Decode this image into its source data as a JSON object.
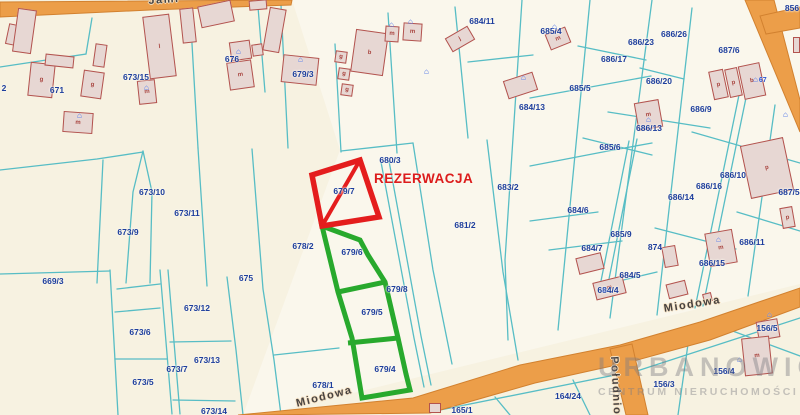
{
  "map": {
    "title": "cadastral parcel map",
    "colors": {
      "background": "#f7f2e1",
      "parcel_line": "#57bdc5",
      "road_fill": "#ec9e49",
      "road_edge": "#d2812f",
      "building_fill": "#e7d7d3",
      "building_edge": "#b3534e",
      "label_blue": "#1d3e9d",
      "reservation_red": "#dc1c1c",
      "highlight_green": "#28a92d"
    },
    "reservation": {
      "label": "REZERWACJA"
    },
    "watermark": {
      "line1": "URBANOWICZ",
      "line2": "CENTRUM NIERUCHOMOŚCI"
    },
    "streets": [
      {
        "name": "Jami",
        "x": 148,
        "y": -5,
        "rot": -4
      },
      {
        "name": "Miodowa",
        "x": 663,
        "y": 303,
        "rot": -9
      },
      {
        "name": "Miodowa",
        "x": 295,
        "y": 398,
        "rot": -14
      },
      {
        "name": "Południowa",
        "x": 620,
        "y": 356,
        "rot": 87
      }
    ],
    "parcel_labels": [
      {
        "t": "2",
        "x": 4,
        "y": 88
      },
      {
        "t": "671",
        "x": 57,
        "y": 90
      },
      {
        "t": "673/15",
        "x": 136,
        "y": 77
      },
      {
        "t": "676",
        "x": 232,
        "y": 59
      },
      {
        "t": "679/3",
        "x": 303,
        "y": 74
      },
      {
        "t": "684/11",
        "x": 482,
        "y": 21
      },
      {
        "t": "685/4",
        "x": 551,
        "y": 31
      },
      {
        "t": "686/23",
        "x": 641,
        "y": 42
      },
      {
        "t": "686/26",
        "x": 674,
        "y": 34
      },
      {
        "t": "687/6",
        "x": 729,
        "y": 50
      },
      {
        "t": "856",
        "x": 792,
        "y": 8
      },
      {
        "t": "686/17",
        "x": 614,
        "y": 59
      },
      {
        "t": "686/20",
        "x": 659,
        "y": 81
      },
      {
        "t": "685/5",
        "x": 580,
        "y": 88
      },
      {
        "t": "684/13",
        "x": 532,
        "y": 107
      },
      {
        "t": "686/9",
        "x": 701,
        "y": 109
      },
      {
        "t": "686/13",
        "x": 649,
        "y": 128
      },
      {
        "t": "685/6",
        "x": 610,
        "y": 147
      },
      {
        "t": "686/10",
        "x": 733,
        "y": 175
      },
      {
        "t": "686/16",
        "x": 709,
        "y": 186
      },
      {
        "t": "686/14",
        "x": 681,
        "y": 197
      },
      {
        "t": "687/5",
        "x": 789,
        "y": 192
      },
      {
        "t": "684/6",
        "x": 578,
        "y": 210
      },
      {
        "t": "685/9",
        "x": 621,
        "y": 234
      },
      {
        "t": "686/11",
        "x": 752,
        "y": 242
      },
      {
        "t": "684/7",
        "x": 592,
        "y": 248
      },
      {
        "t": "874",
        "x": 655,
        "y": 247
      },
      {
        "t": "686/15",
        "x": 712,
        "y": 263
      },
      {
        "t": "684/5",
        "x": 630,
        "y": 275
      },
      {
        "t": "684/4",
        "x": 608,
        "y": 290
      },
      {
        "t": "673/10",
        "x": 152,
        "y": 192
      },
      {
        "t": "673/11",
        "x": 187,
        "y": 213
      },
      {
        "t": "673/9",
        "x": 128,
        "y": 232
      },
      {
        "t": "680/3",
        "x": 390,
        "y": 160
      },
      {
        "t": "679/7",
        "x": 344,
        "y": 191
      },
      {
        "t": "683/2",
        "x": 508,
        "y": 187
      },
      {
        "t": "681/2",
        "x": 465,
        "y": 225
      },
      {
        "t": "678/2",
        "x": 303,
        "y": 246
      },
      {
        "t": "679/6",
        "x": 352,
        "y": 252
      },
      {
        "t": "675",
        "x": 246,
        "y": 278
      },
      {
        "t": "679/8",
        "x": 397,
        "y": 289
      },
      {
        "t": "679/5",
        "x": 372,
        "y": 312
      },
      {
        "t": "669/3",
        "x": 53,
        "y": 281
      },
      {
        "t": "673/12",
        "x": 197,
        "y": 308
      },
      {
        "t": "673/6",
        "x": 140,
        "y": 332
      },
      {
        "t": "673/13",
        "x": 207,
        "y": 360
      },
      {
        "t": "673/7",
        "x": 177,
        "y": 369
      },
      {
        "t": "679/4",
        "x": 385,
        "y": 369
      },
      {
        "t": "673/5",
        "x": 143,
        "y": 382
      },
      {
        "t": "678/1",
        "x": 323,
        "y": 385
      },
      {
        "t": "673/14",
        "x": 214,
        "y": 411
      },
      {
        "t": "156/5",
        "x": 767,
        "y": 328
      },
      {
        "t": "156/4",
        "x": 724,
        "y": 371
      },
      {
        "t": "156/3",
        "x": 664,
        "y": 384
      },
      {
        "t": "164/24",
        "x": 568,
        "y": 396
      },
      {
        "t": "165/1",
        "x": 462,
        "y": 410
      }
    ],
    "buildings": [
      {
        "x": 7,
        "y": 24,
        "w": 10,
        "h": 21,
        "r": 12,
        "l": ""
      },
      {
        "x": 15,
        "y": 9,
        "w": 19,
        "h": 44,
        "r": 8,
        "l": ""
      },
      {
        "x": 29,
        "y": 63,
        "w": 25,
        "h": 34,
        "r": 6,
        "l": "g"
      },
      {
        "x": 45,
        "y": 55,
        "w": 29,
        "h": 12,
        "r": 6,
        "l": ""
      },
      {
        "x": 82,
        "y": 71,
        "w": 21,
        "h": 27,
        "r": 8,
        "l": "g"
      },
      {
        "x": 94,
        "y": 44,
        "w": 12,
        "h": 23,
        "r": 8,
        "l": ""
      },
      {
        "x": 138,
        "y": 80,
        "w": 18,
        "h": 24,
        "r": -6,
        "l": "m"
      },
      {
        "x": 146,
        "y": 15,
        "w": 27,
        "h": 63,
        "r": -7,
        "l": "l"
      },
      {
        "x": 181,
        "y": 8,
        "w": 14,
        "h": 35,
        "r": -6,
        "l": ""
      },
      {
        "x": 199,
        "y": 3,
        "w": 34,
        "h": 22,
        "r": -12,
        "l": ""
      },
      {
        "x": 228,
        "y": 61,
        "w": 25,
        "h": 28,
        "r": -8,
        "l": "m"
      },
      {
        "x": 230,
        "y": 41,
        "w": 21,
        "h": 19,
        "r": -8,
        "l": ""
      },
      {
        "x": 252,
        "y": 44,
        "w": 11,
        "h": 12,
        "r": -8,
        "l": ""
      },
      {
        "x": 63,
        "y": 112,
        "w": 30,
        "h": 21,
        "r": 4,
        "l": "m"
      },
      {
        "x": 249,
        "y": 0,
        "w": 18,
        "h": 10,
        "r": -5,
        "l": ""
      },
      {
        "x": 266,
        "y": 8,
        "w": 17,
        "h": 44,
        "r": 10,
        "l": ""
      },
      {
        "x": 282,
        "y": 56,
        "w": 36,
        "h": 28,
        "r": 6,
        "l": ""
      },
      {
        "x": 335,
        "y": 51,
        "w": 12,
        "h": 12,
        "r": 8,
        "l": "g"
      },
      {
        "x": 338,
        "y": 68,
        "w": 12,
        "h": 12,
        "r": 8,
        "l": "g"
      },
      {
        "x": 341,
        "y": 84,
        "w": 12,
        "h": 12,
        "r": 8,
        "l": "g"
      },
      {
        "x": 353,
        "y": 31,
        "w": 33,
        "h": 43,
        "r": 8,
        "l": "b"
      },
      {
        "x": 385,
        "y": 26,
        "w": 14,
        "h": 16,
        "r": 4,
        "l": "m"
      },
      {
        "x": 403,
        "y": 23,
        "w": 19,
        "h": 18,
        "r": 4,
        "l": "m"
      },
      {
        "x": 447,
        "y": 31,
        "w": 26,
        "h": 16,
        "r": -30,
        "l": "j"
      },
      {
        "x": 505,
        "y": 76,
        "w": 31,
        "h": 19,
        "r": -18,
        "l": ""
      },
      {
        "x": 547,
        "y": 30,
        "w": 22,
        "h": 17,
        "r": -22,
        "l": "m"
      },
      {
        "x": 636,
        "y": 101,
        "w": 25,
        "h": 28,
        "r": -10,
        "l": "m"
      },
      {
        "x": 711,
        "y": 70,
        "w": 15,
        "h": 29,
        "r": -12,
        "l": "p"
      },
      {
        "x": 727,
        "y": 68,
        "w": 13,
        "h": 29,
        "r": -12,
        "l": "p"
      },
      {
        "x": 741,
        "y": 64,
        "w": 22,
        "h": 34,
        "r": -12,
        "l": "b"
      },
      {
        "x": 781,
        "y": 207,
        "w": 13,
        "h": 21,
        "r": -10,
        "l": "p"
      },
      {
        "x": 745,
        "y": 141,
        "w": 44,
        "h": 54,
        "r": -12,
        "l": "p"
      },
      {
        "x": 707,
        "y": 231,
        "w": 28,
        "h": 34,
        "r": -10,
        "l": "m"
      },
      {
        "x": 663,
        "y": 246,
        "w": 14,
        "h": 21,
        "r": -10,
        "l": ""
      },
      {
        "x": 577,
        "y": 255,
        "w": 26,
        "h": 17,
        "r": -14,
        "l": ""
      },
      {
        "x": 594,
        "y": 279,
        "w": 31,
        "h": 18,
        "r": -14,
        "l": "m"
      },
      {
        "x": 667,
        "y": 282,
        "w": 20,
        "h": 15,
        "r": -14,
        "l": ""
      },
      {
        "x": 703,
        "y": 293,
        "w": 9,
        "h": 9,
        "r": -14,
        "l": ""
      },
      {
        "x": 757,
        "y": 320,
        "w": 22,
        "h": 19,
        "r": -10,
        "l": ""
      },
      {
        "x": 743,
        "y": 337,
        "w": 28,
        "h": 38,
        "r": -6,
        "l": "m"
      },
      {
        "x": 429,
        "y": 403,
        "w": 12,
        "h": 10,
        "r": 0,
        "l": ""
      },
      {
        "x": 793,
        "y": 37,
        "w": 7,
        "h": 16,
        "r": 0,
        "l": ""
      }
    ],
    "address_icons": [
      {
        "x": 77,
        "y": 112,
        "t": ""
      },
      {
        "x": 144,
        "y": 84,
        "t": ""
      },
      {
        "x": 236,
        "y": 48,
        "t": ""
      },
      {
        "x": 298,
        "y": 56,
        "t": ""
      },
      {
        "x": 389,
        "y": 21,
        "t": ""
      },
      {
        "x": 408,
        "y": 18,
        "t": ""
      },
      {
        "x": 424,
        "y": 68,
        "t": ""
      },
      {
        "x": 521,
        "y": 74,
        "t": ""
      },
      {
        "x": 552,
        "y": 23,
        "t": ""
      },
      {
        "x": 646,
        "y": 116,
        "t": ""
      },
      {
        "x": 753,
        "y": 76,
        "t": "67"
      },
      {
        "x": 767,
        "y": 311,
        "t": ""
      },
      {
        "x": 737,
        "y": 356,
        "t": ""
      },
      {
        "x": 716,
        "y": 236,
        "t": ""
      },
      {
        "x": 602,
        "y": 286,
        "t": ""
      },
      {
        "x": 783,
        "y": 111,
        "t": ""
      }
    ]
  }
}
